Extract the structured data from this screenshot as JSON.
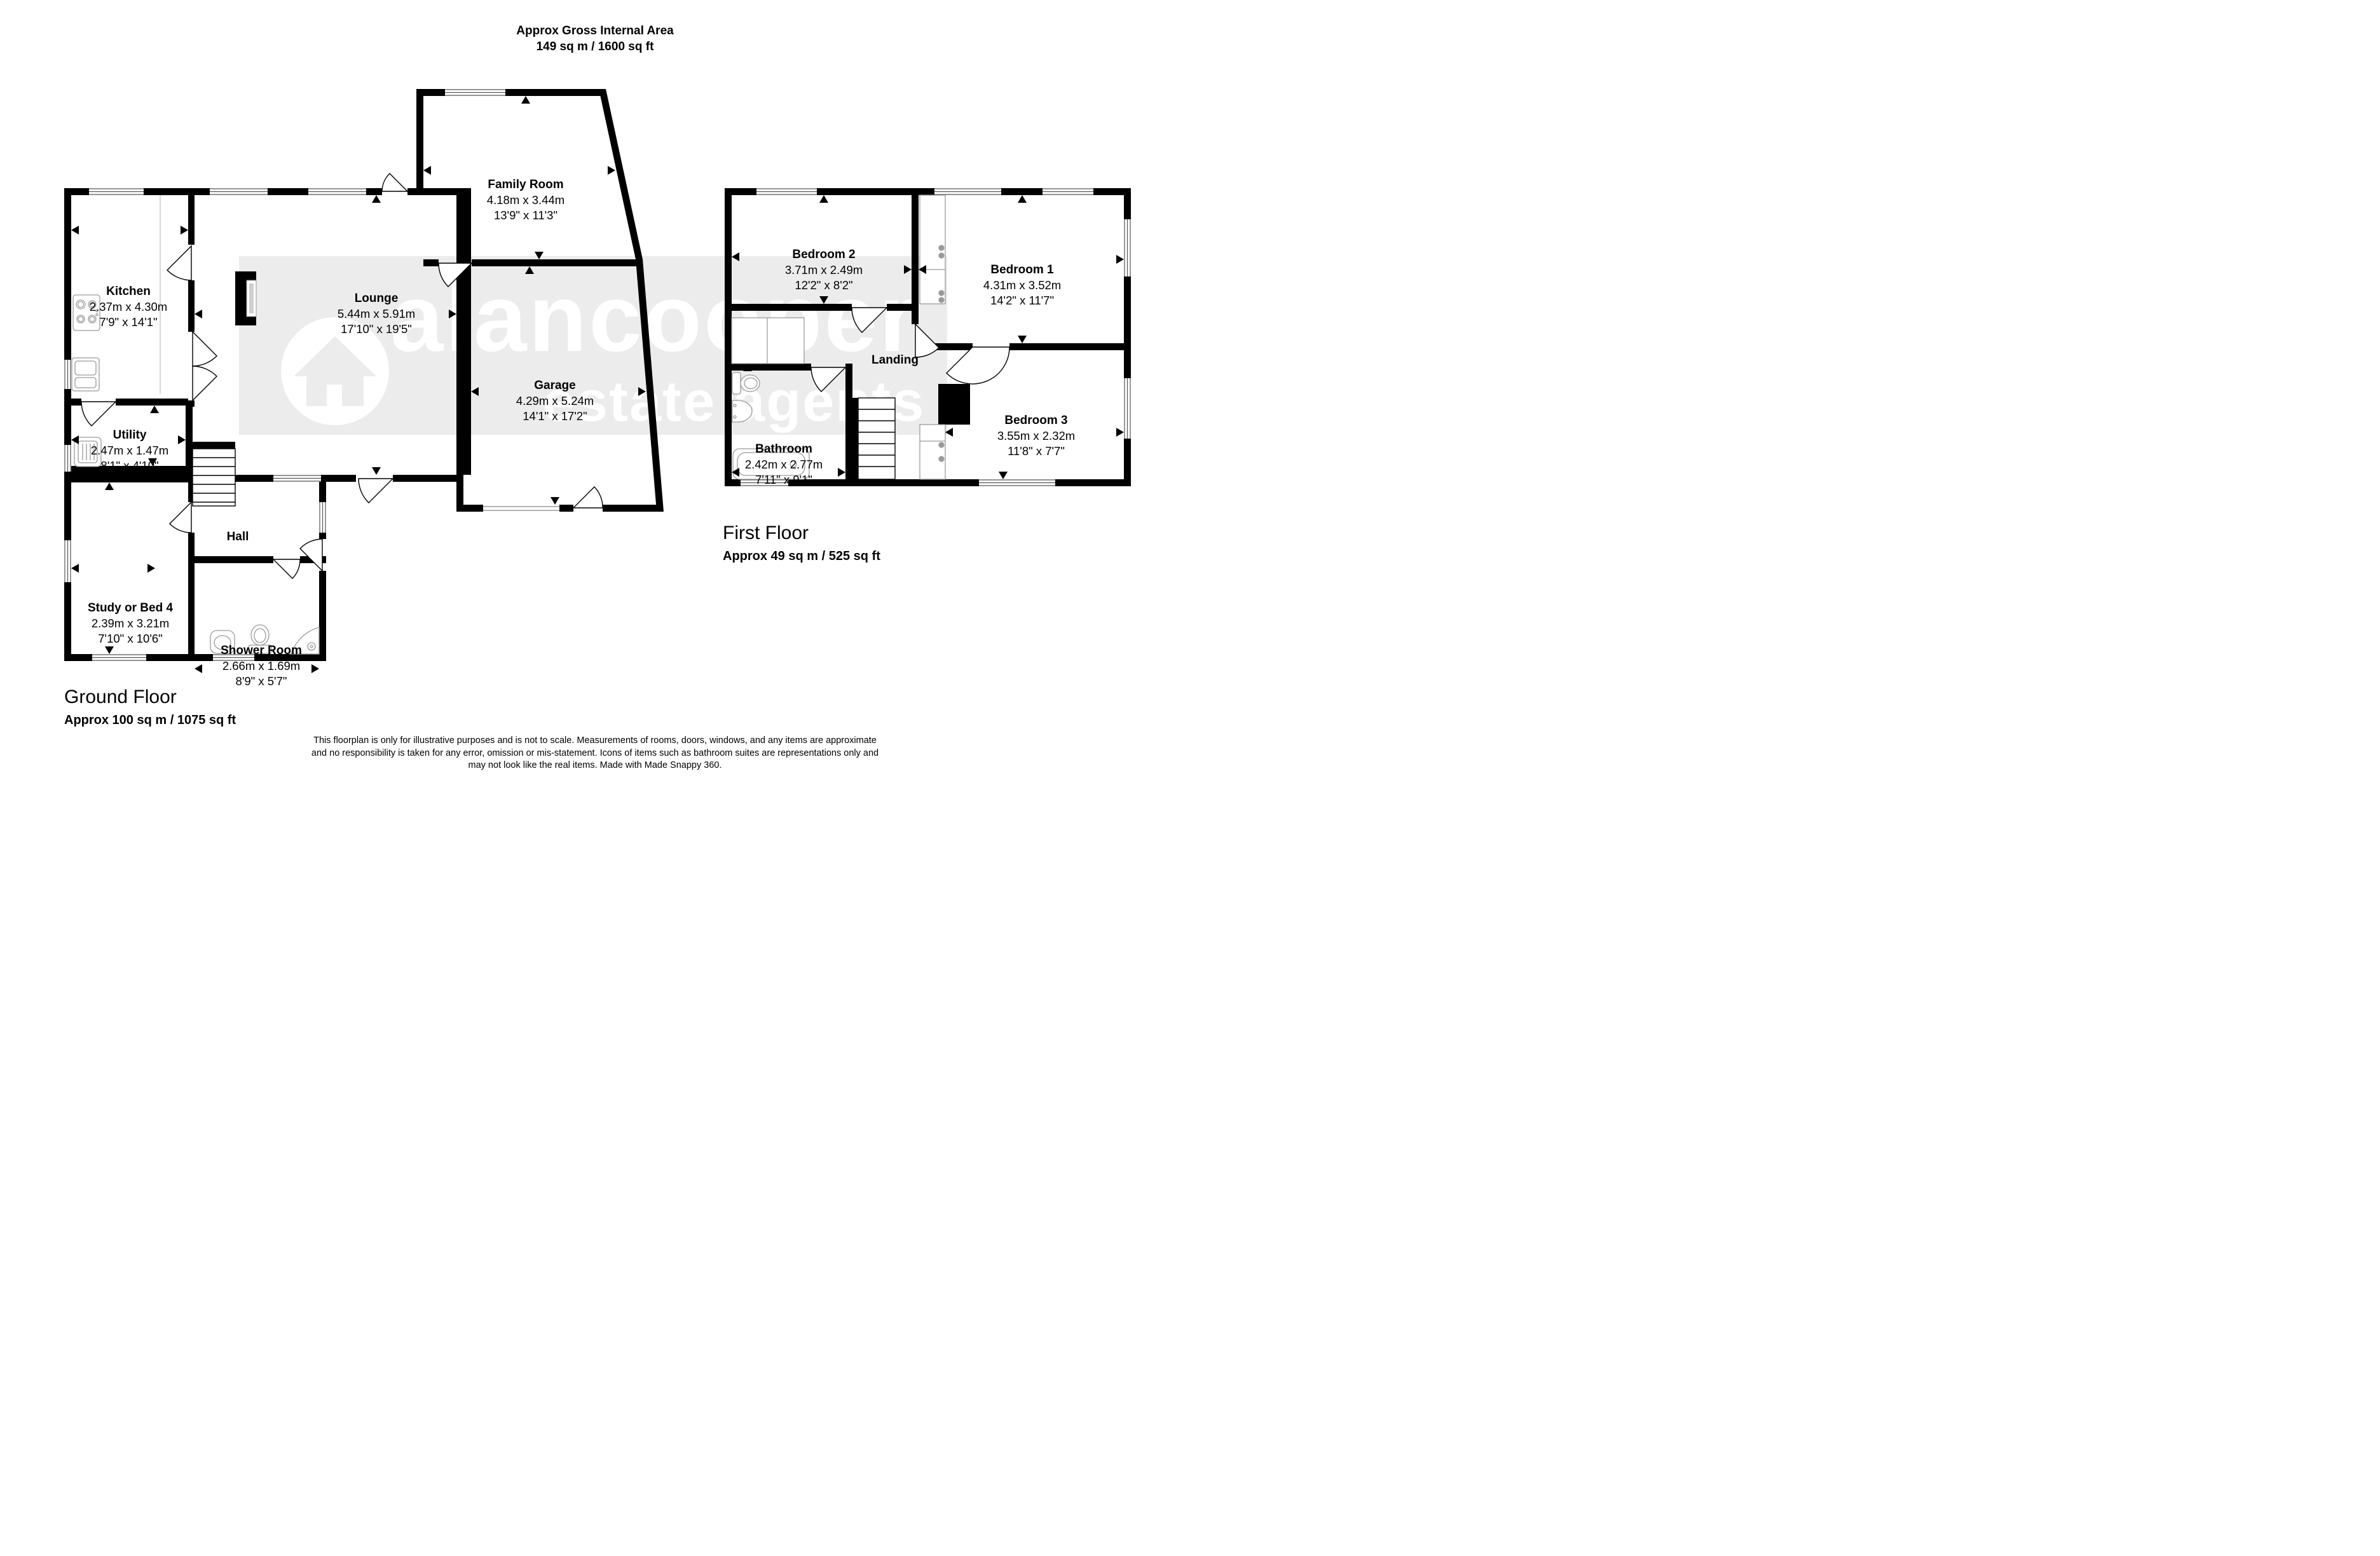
{
  "title": {
    "line1": "Approx Gross Internal Area",
    "line2": "149 sq m / 1600 sq ft"
  },
  "watermark": {
    "brand": "alancooper",
    "tagline": "estate agents",
    "band_color": "#ececec"
  },
  "colors": {
    "walls": "#000000",
    "fixture_outline": "#9a9a9a",
    "window_line": "#555555"
  },
  "ground_floor": {
    "caption": "Ground Floor",
    "area": "Approx 100 sq m / 1075 sq ft",
    "rooms": [
      {
        "name": "Kitchen",
        "metric": "2.37m x 4.30m",
        "imperial": "7'9\" x 14'1\""
      },
      {
        "name": "Lounge",
        "metric": "5.44m x 5.91m",
        "imperial": "17'10\" x 19'5\""
      },
      {
        "name": "Family Room",
        "metric": "4.18m x 3.44m",
        "imperial": "13'9\" x 11'3\""
      },
      {
        "name": "Garage",
        "metric": "4.29m x 5.24m",
        "imperial": "14'1\" x 17'2\""
      },
      {
        "name": "Utility",
        "metric": "2.47m x 1.47m",
        "imperial": "8'1\" x 4'10\""
      },
      {
        "name": "Hall"
      },
      {
        "name": "Study or Bed 4",
        "metric": "2.39m x 3.21m",
        "imperial": "7'10\" x 10'6\""
      },
      {
        "name": "Shower Room",
        "metric": "2.66m x 1.69m",
        "imperial": "8'9\" x 5'7\""
      }
    ]
  },
  "first_floor": {
    "caption": "First Floor",
    "area": "Approx 49 sq m / 525 sq ft",
    "rooms": [
      {
        "name": "Bedroom 2",
        "metric": "3.71m x 2.49m",
        "imperial": "12'2\" x 8'2\""
      },
      {
        "name": "Bedroom 1",
        "metric": "4.31m x 3.52m",
        "imperial": "14'2\" x 11'7\""
      },
      {
        "name": "Landing"
      },
      {
        "name": "Bathroom",
        "metric": "2.42m x 2.77m",
        "imperial": "7'11\" x 9'1\""
      },
      {
        "name": "Bedroom 3",
        "metric": "3.55m x 2.32m",
        "imperial": "11'8\" x 7'7\""
      }
    ]
  },
  "disclaimer": {
    "line1": "This floorplan is only for illustrative purposes and is not to scale. Measurements of rooms, doors, windows, and any items are approximate",
    "line2": "and no responsibility is taken for any error, omission or mis-statement. Icons of items such as bathroom suites are representations only and",
    "line3": "may not look like the real items. Made with Made Snappy 360."
  }
}
